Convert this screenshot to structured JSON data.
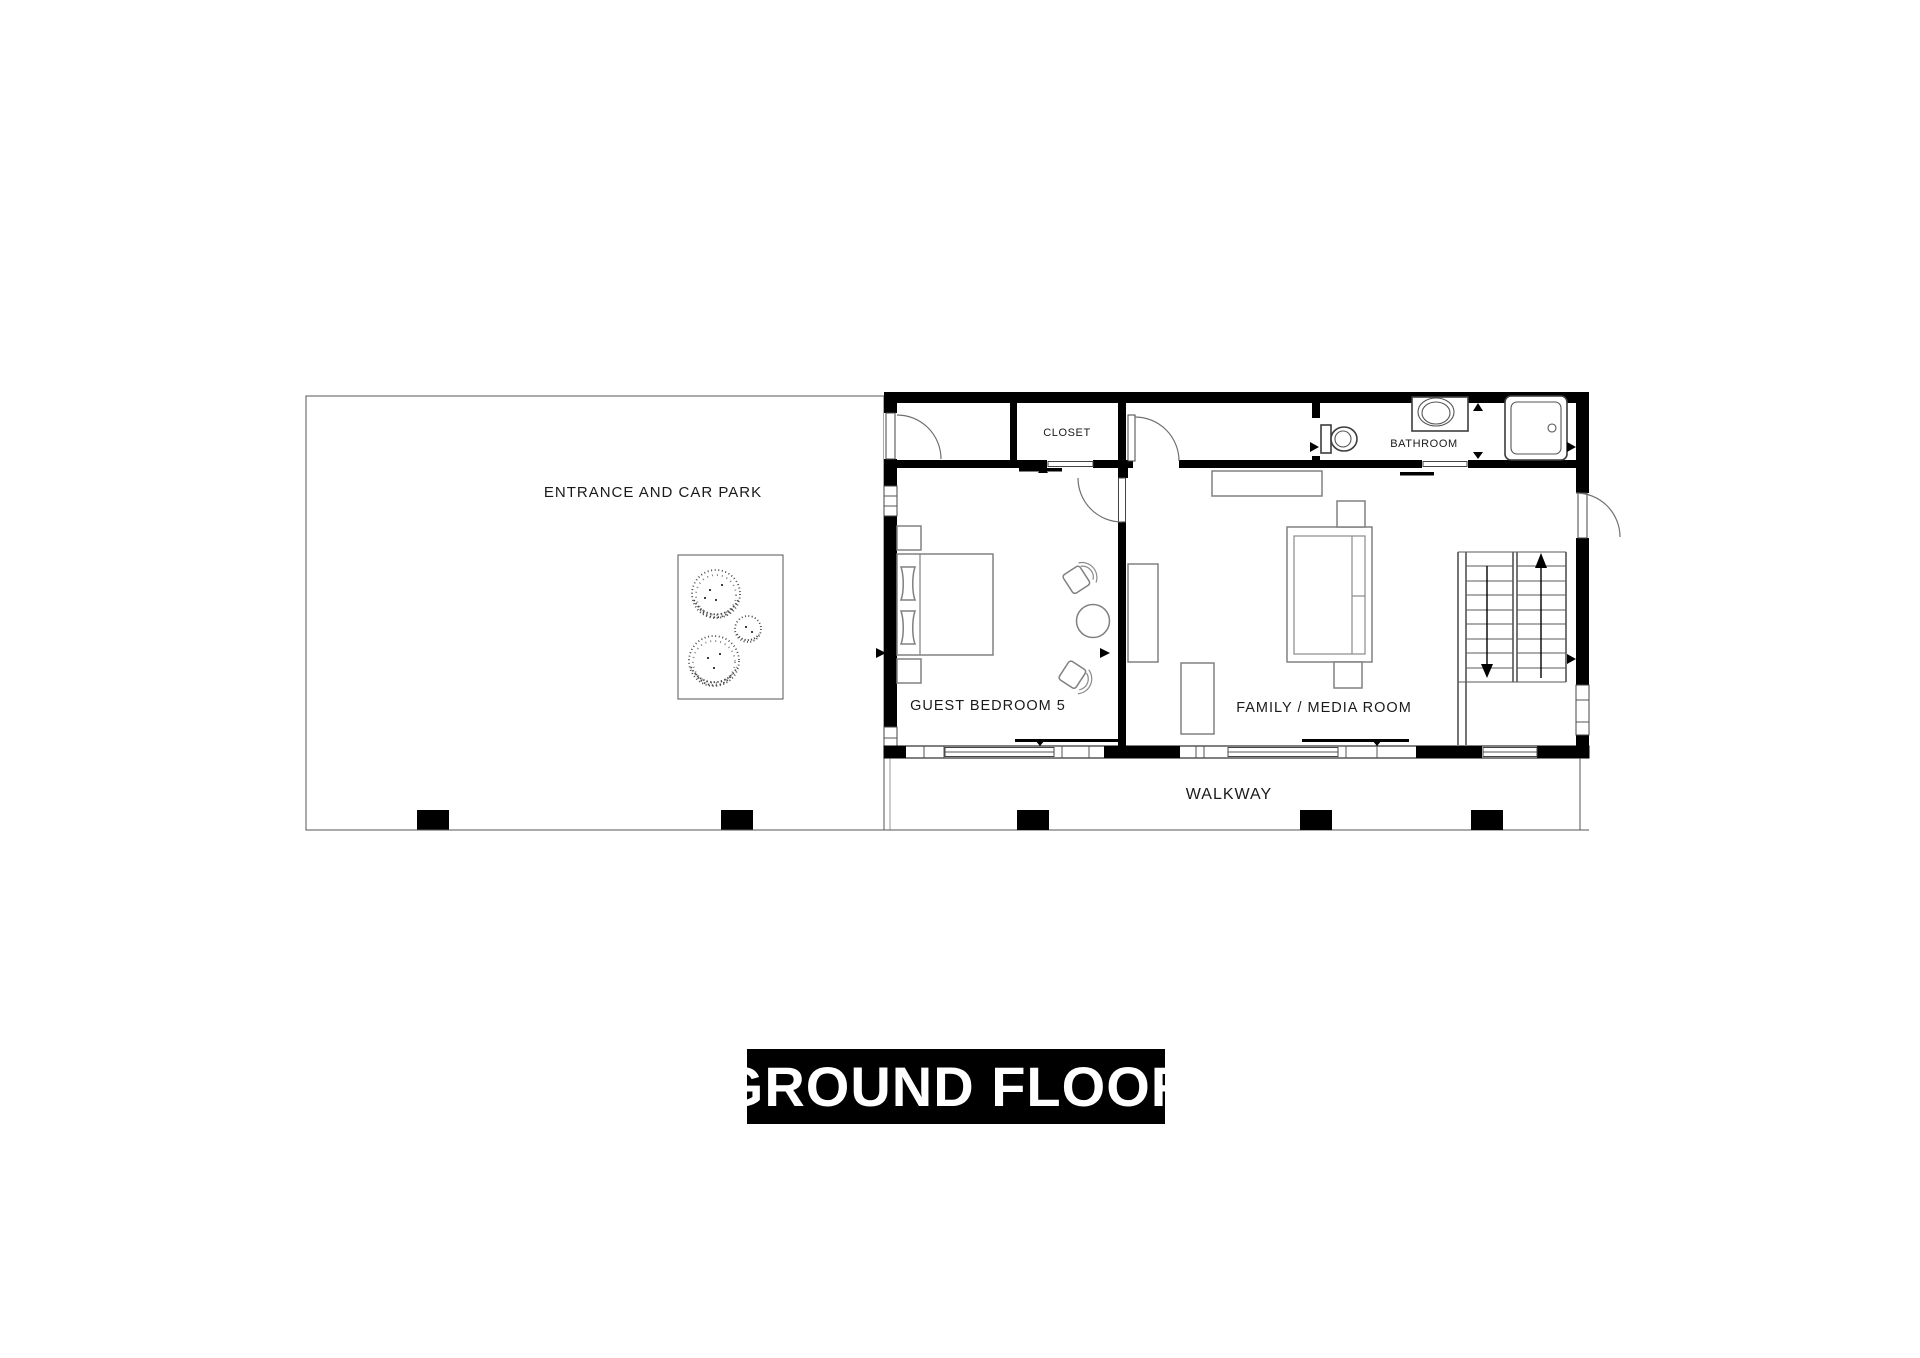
{
  "plan": {
    "title": "GROUND FLOOR",
    "rooms": {
      "entrance": "ENTRANCE AND CAR PARK",
      "closet": "CLOSET",
      "bathroom": "BATHROOM",
      "guest_bedroom": "GUEST BEDROOM 5",
      "family_room": "FAMILY / MEDIA ROOM",
      "walkway": "WALKWAY"
    },
    "colors": {
      "wall": "#000000",
      "furniture_line": "#808080",
      "fixture_line": "#3d3d3d",
      "background": "#ffffff",
      "title_background": "#000000",
      "title_text": "#ffffff"
    }
  }
}
